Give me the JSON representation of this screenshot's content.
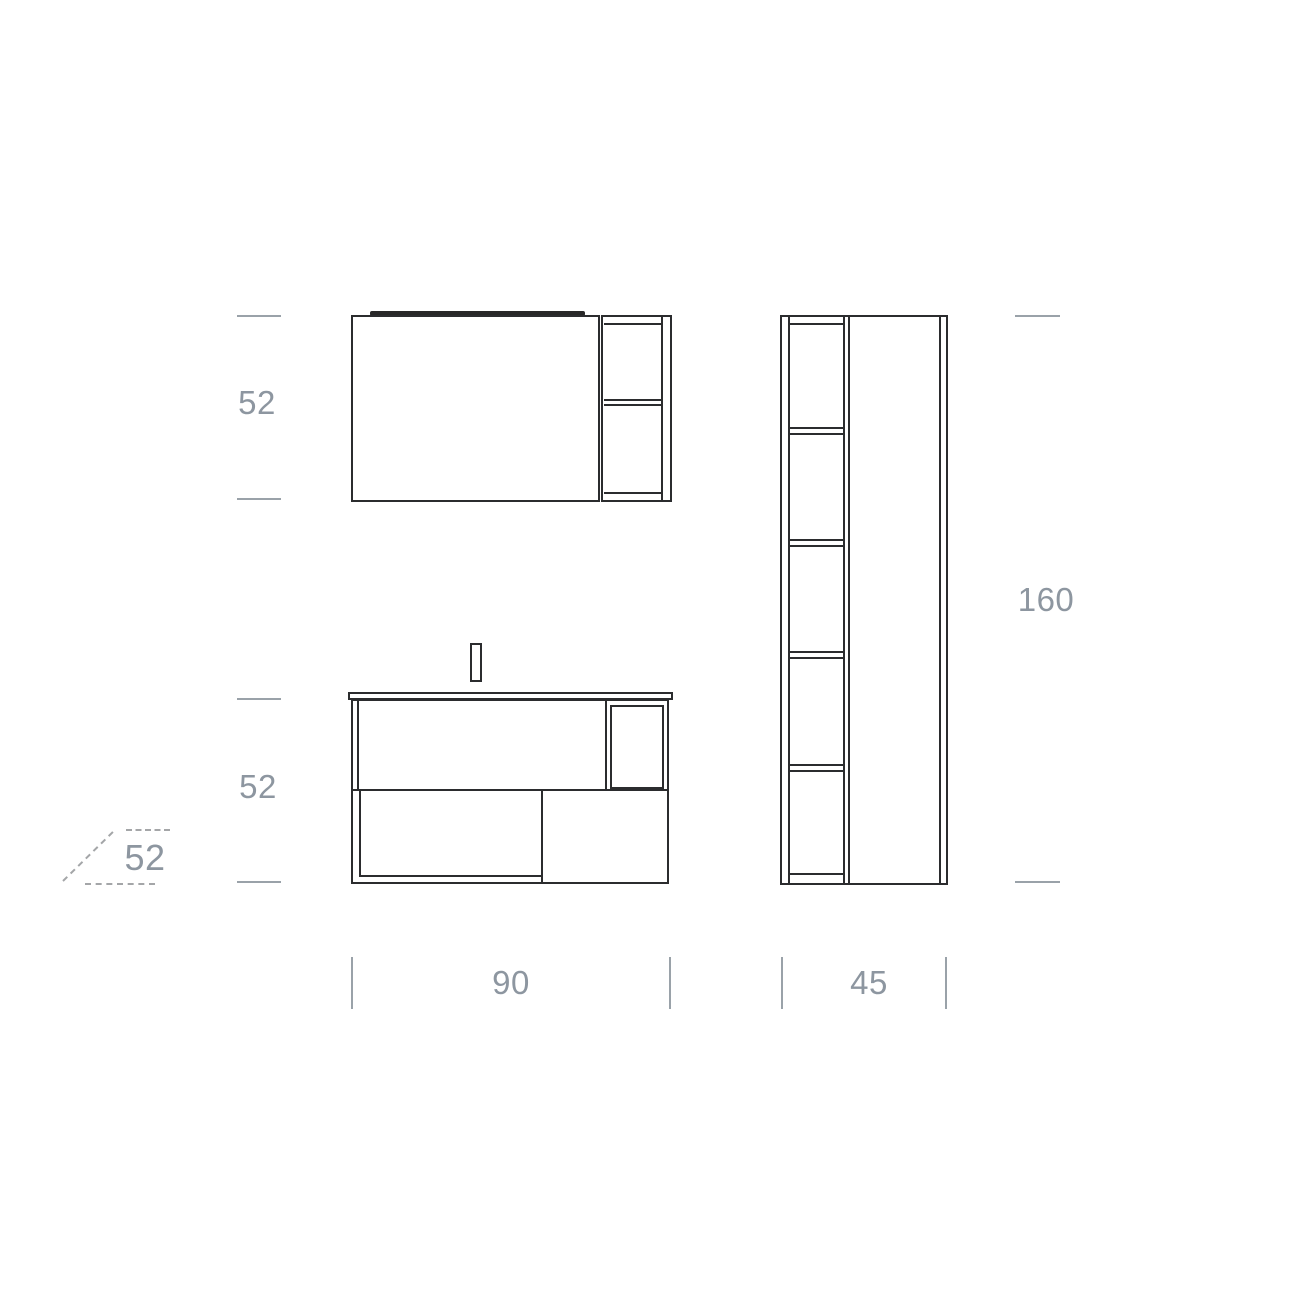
{
  "colors": {
    "background": "#ffffff",
    "drawing_line": "#2b2c2e",
    "light_bar": "#282828",
    "dim_tick": "#9aa2a9",
    "dim_text": "#8d96a0",
    "dash_line": "#a4a6a8"
  },
  "dimensions": {
    "mirror_unit_height": "52",
    "vanity_unit_height": "52",
    "depth": "52",
    "tall_unit_height": "160",
    "vanity_unit_width": "90",
    "tall_unit_width": "45"
  }
}
